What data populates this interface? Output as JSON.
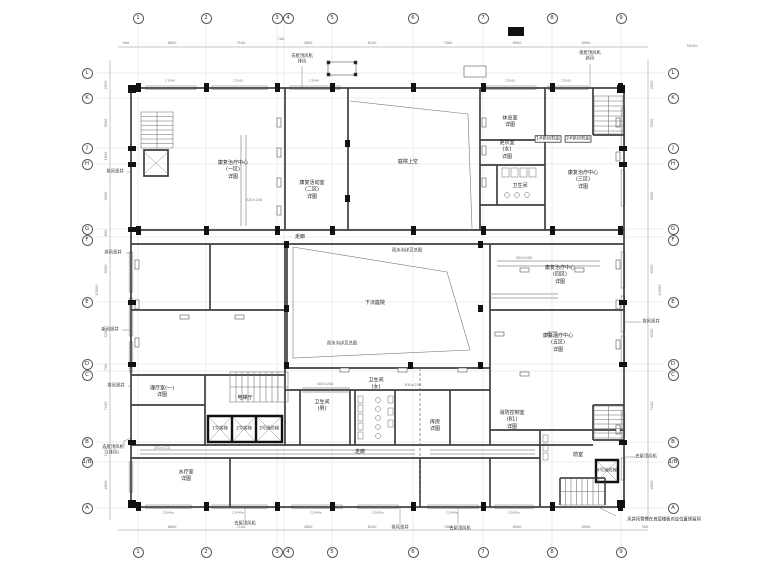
{
  "ax": {
    "t": [
      "1",
      "2",
      "3",
      "4",
      "5",
      "6",
      "7",
      "8",
      "9"
    ],
    "s": [
      "L",
      "K",
      "J",
      "H",
      "G",
      "F",
      "E",
      "D",
      "C",
      "B",
      "1/B",
      "A"
    ]
  },
  "dt": [
    "6800",
    "7100",
    "700",
    "4800",
    "8100",
    "7000",
    "6900",
    "6900"
  ],
  "dl": [
    "2500",
    "5000",
    "1600",
    "6500",
    "800",
    "6500",
    "6200",
    "700",
    "7100",
    "2000",
    "4600"
  ],
  "tot": {
    "t": "50100",
    "s": "43500",
    "e": "900"
  },
  "rm": [
    "康复治疗中心\n(一区)\n详图",
    "康复活动室\n(二区)\n详图",
    "庭院上空",
    "下沉庭院",
    "休息室\n详图",
    "更衣室\n(女)\n详图",
    "康复治疗中心\n(三区)\n详图",
    "康复治疗中心\n(四区)\n详图",
    "康复治疗中心\n(五区)\n详图",
    "理疗室(一)\n详图",
    "卫生间\n(男)",
    "走廊",
    "库房\n详图",
    "消防控制室\n(B1)\n详图",
    "水疗室\n详图",
    "电梯厅",
    "走廊",
    "卫生间",
    "卫生间\n(女)",
    "前室"
  ],
  "ol": [
    "排风竖井",
    "排风竖井",
    "新风竖井",
    "排风竖井",
    "去屋顶风机\n(排风)",
    "去屋顶风机\n排风",
    "接屋顶风机\n新风",
    "排风竖井",
    "去屋顶风机",
    "排风竖井",
    "去屋顶风机",
    "去屋顶风机"
  ],
  "eq": [
    "1#新风机组",
    "2#新风机组",
    "320×200",
    "630×250",
    "500×200",
    "400×200",
    "雨水沟详见总图",
    "250×120"
  ],
  "el": [
    "1号客梯",
    "2号客梯",
    "3号消防梯",
    "4号消防梯"
  ],
  "wt": [
    "C2040a",
    "C1540",
    "C2040"
  ],
  "note": "风井风管需在首层楼板对应位置预留洞"
}
